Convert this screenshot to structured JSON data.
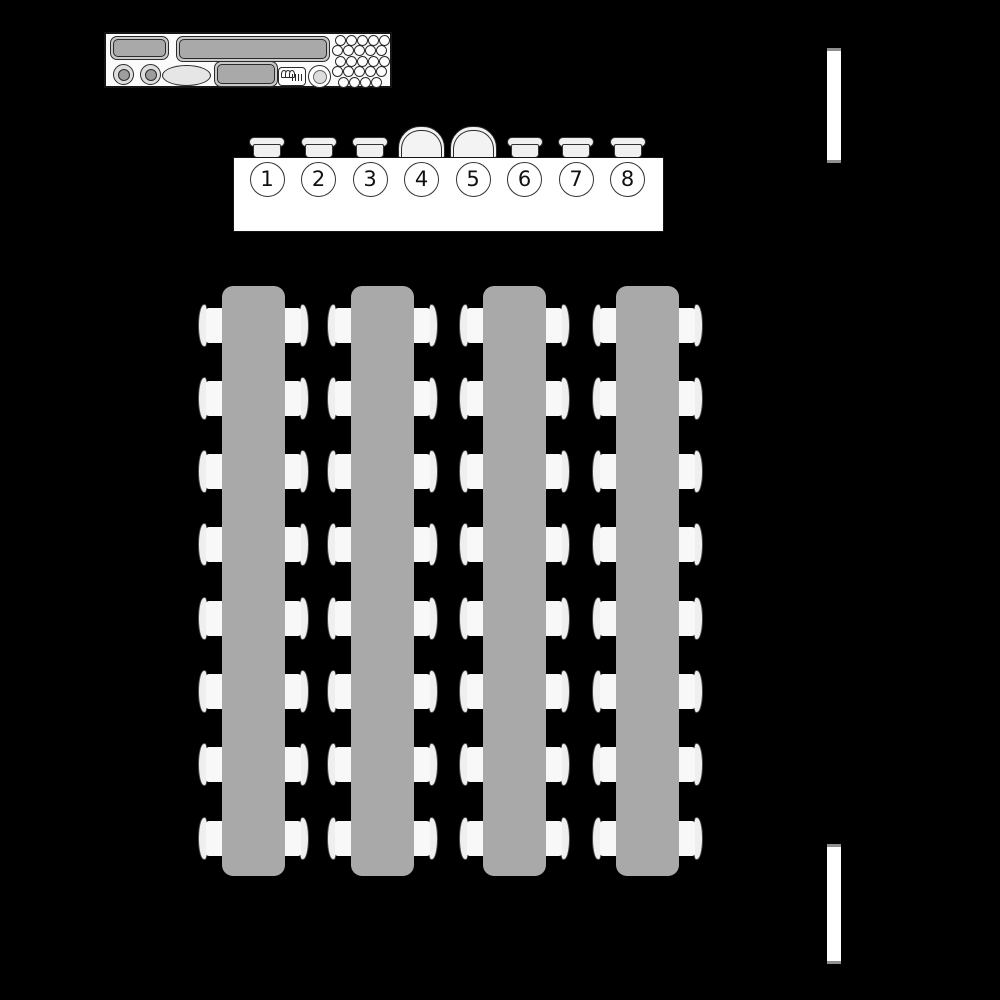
{
  "diagram": {
    "background_color": "#000000",
    "service_counter": {
      "fill": "#fbfbfb",
      "equipment": [
        "counter-unit-small",
        "counter-unit-long",
        "glass-rack",
        "burner-left",
        "burner-right",
        "serving-platter",
        "counter-unit-center",
        "register-box",
        "stool"
      ],
      "glass_rack_rows": [
        5,
        5,
        5,
        5,
        4
      ]
    },
    "head_table": {
      "fill": "#ffffff",
      "seat_count": 8,
      "seats": [
        {
          "number": "1",
          "chair_type": "standard"
        },
        {
          "number": "2",
          "chair_type": "standard"
        },
        {
          "number": "3",
          "chair_type": "standard"
        },
        {
          "number": "4",
          "chair_type": "armchair"
        },
        {
          "number": "5",
          "chair_type": "armchair"
        },
        {
          "number": "6",
          "chair_type": "standard"
        },
        {
          "number": "7",
          "chair_type": "standard"
        },
        {
          "number": "8",
          "chair_type": "standard"
        }
      ]
    },
    "banquet_tables": {
      "count": 4,
      "chairs_per_side": 8,
      "table_fill": "#a9a9a9",
      "chair_seat_fill": "#f8f8f8",
      "chair_back_fill": "#efefef"
    },
    "wall_openings": {
      "count": 2,
      "fill": "#ffffff",
      "positions": [
        "top-right",
        "bottom-right"
      ]
    }
  }
}
